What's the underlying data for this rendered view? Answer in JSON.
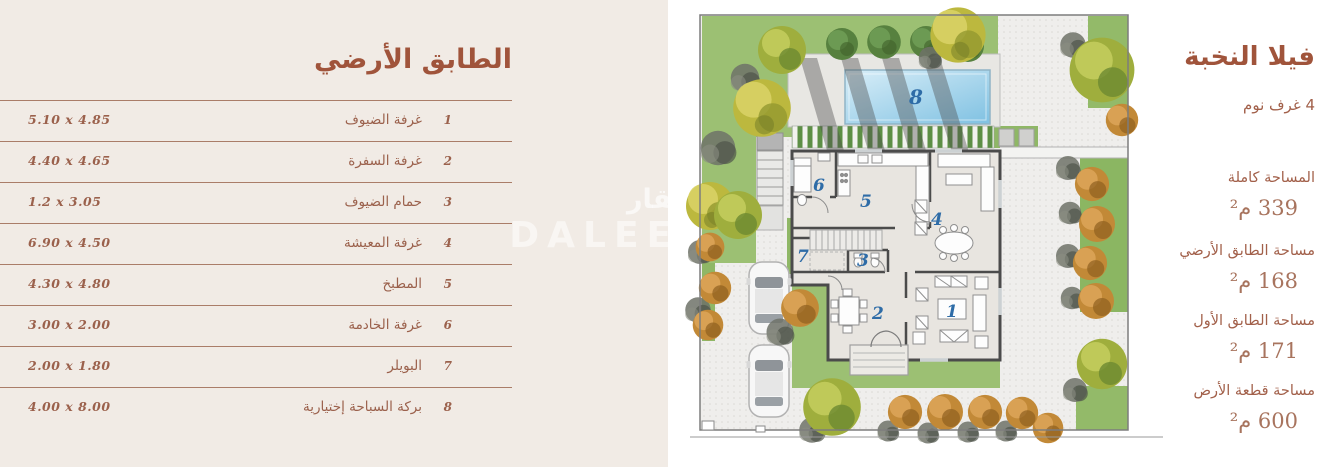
{
  "floor_table": {
    "title": "الطابق الأرضي",
    "rows": [
      {
        "num": "1",
        "name": "غرفة الضيوف",
        "dims": "5.10 x 4.85"
      },
      {
        "num": "2",
        "name": "غرفة السفرة",
        "dims": "4.40 x 4.65"
      },
      {
        "num": "3",
        "name": "حمام الضيوف",
        "dims": "1.2 x 3.05"
      },
      {
        "num": "4",
        "name": "غرفة المعيشة",
        "dims": "6.90 x 4.50"
      },
      {
        "num": "5",
        "name": "المطبخ",
        "dims": "4.30 x 4.80"
      },
      {
        "num": "6",
        "name": "غرفة الخادمة",
        "dims": "3.00 x 2.00"
      },
      {
        "num": "7",
        "name": "البويلر",
        "dims": "2.00 x 1.80"
      },
      {
        "num": "8",
        "name": "بركة السباحة إختيارية",
        "dims": "4.00 x 8.00"
      }
    ]
  },
  "villa_info": {
    "title": "فيلا النخبة",
    "bedrooms": "4 غرف نوم",
    "areas": [
      {
        "label": "المساحة كاملة",
        "value": "339 م²"
      },
      {
        "label": "مساحة الطابق الأرضي",
        "value": "168 م²"
      },
      {
        "label": "مساحة الطابق الأول",
        "value": "171 م²"
      },
      {
        "label": "مساحة قطعة الأرض",
        "value": "600 م²"
      }
    ]
  },
  "plan": {
    "numbers": {
      "n1": "1",
      "n2": "2",
      "n3": "3",
      "n4": "4",
      "n5": "5",
      "n6": "6",
      "n7": "7",
      "n8": "8"
    }
  },
  "watermark": {
    "ar": "دليل عقار",
    "en": "DALEEL AQAR"
  },
  "colors": {
    "accent_brick": "#a0543b",
    "panel_cream": "#f1ebe5",
    "plan_number_blue": "#2e6ca7",
    "pool_blue": "#8ec7e4",
    "grass_green": "#9cc073",
    "wall_gray": "#4b4b4b"
  }
}
